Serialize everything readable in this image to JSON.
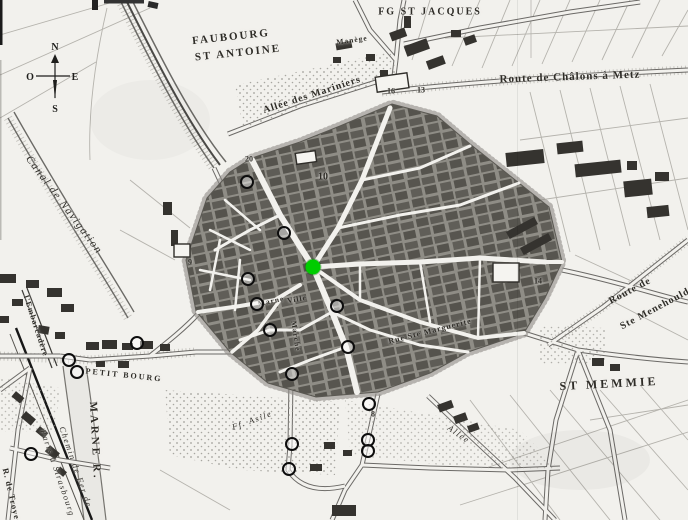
{
  "colors": {
    "paper": "#f2f1ed",
    "ink": "#2e2c27",
    "marker_ring": "#0d0d0d",
    "highlight_green": "#00cc00"
  },
  "compass": {
    "north": "N",
    "west": "O",
    "east": "E",
    "south": "S"
  },
  "labels": [
    {
      "id": "faubourg-line1",
      "text": "Faubourg",
      "x": 231,
      "y": 37,
      "rot": -6,
      "size": 11,
      "cls": "caps"
    },
    {
      "id": "faubourg-line2",
      "text": "St Antoine",
      "x": 238,
      "y": 53,
      "rot": -6,
      "size": 11,
      "cls": "caps"
    },
    {
      "id": "fg-st-jacques",
      "text": "Fg St Jacques",
      "x": 430,
      "y": 12,
      "rot": 0,
      "size": 10,
      "cls": "caps"
    },
    {
      "id": "route-chalons-metz",
      "text": "Route de Châlons à Metz",
      "x": 570,
      "y": 77,
      "rot": -2,
      "size": 11,
      "cls": "road"
    },
    {
      "id": "allee-mariniers",
      "text": "Allée des Mariniers",
      "x": 312,
      "y": 95,
      "rot": -18,
      "size": 10,
      "cls": "road"
    },
    {
      "id": "manege",
      "text": "Manège",
      "x": 352,
      "y": 40,
      "rot": -8,
      "size": 7.5,
      "cls": "road"
    },
    {
      "id": "canal-navigation",
      "text": "Canal de Navigation",
      "x": 64,
      "y": 205,
      "rot": 53,
      "size": 11,
      "cls": "italic"
    },
    {
      "id": "embarcadere",
      "text": "l'Embarcadère",
      "x": 36,
      "y": 326,
      "rot": 72,
      "size": 8,
      "cls": "road"
    },
    {
      "id": "petit-bourg",
      "text": "Petit Bourg",
      "x": 124,
      "y": 375,
      "rot": 6,
      "size": 8,
      "cls": "caps"
    },
    {
      "id": "marne-r",
      "text": "Marne R.",
      "x": 95,
      "y": 441,
      "rot": 87,
      "size": 11,
      "cls": "big"
    },
    {
      "id": "chemin-de-fer",
      "text": "Chemin de Fer de",
      "x": 76,
      "y": 467,
      "rot": 71,
      "size": 8.5,
      "cls": "italic"
    },
    {
      "id": "paris-strasbourg",
      "text": "Paris à Strasbourg",
      "x": 58,
      "y": 473,
      "rot": 71,
      "size": 8.5,
      "cls": "italic"
    },
    {
      "id": "r-de-troyes",
      "text": "R. de Troyes",
      "x": 12,
      "y": 496,
      "rot": 77,
      "size": 8.5,
      "cls": "road"
    },
    {
      "id": "st-memmie",
      "text": "St Memmie",
      "x": 609,
      "y": 384,
      "rot": -3,
      "size": 12,
      "cls": "big"
    },
    {
      "id": "route-de",
      "text": "Route de",
      "x": 630,
      "y": 291,
      "rot": -28,
      "size": 10,
      "cls": "road"
    },
    {
      "id": "ste-menehould",
      "text": "Ste Menehould",
      "x": 655,
      "y": 309,
      "rot": -28,
      "size": 10,
      "cls": "road"
    },
    {
      "id": "allee",
      "text": "Allée",
      "x": 459,
      "y": 434,
      "rot": 35,
      "size": 8.5,
      "cls": "italic"
    },
    {
      "id": "ff-asile",
      "text": "Ff. Asile",
      "x": 252,
      "y": 420,
      "rot": -20,
      "size": 8.5,
      "cls": "italic"
    },
    {
      "id": "marne-street",
      "text": "Marne",
      "x": 271,
      "y": 301,
      "rot": -12,
      "size": 7.5,
      "cls": "road"
    },
    {
      "id": "ville-street",
      "text": "Ville",
      "x": 297,
      "y": 299,
      "rot": -10,
      "size": 7.5,
      "cls": "road"
    },
    {
      "id": "marche-street",
      "text": "Marché",
      "x": 296,
      "y": 336,
      "rot": 82,
      "size": 7.5,
      "cls": "road"
    },
    {
      "id": "rue-ste-marguerite",
      "text": "Rue Ste Marguerite",
      "x": 430,
      "y": 331,
      "rot": -14,
      "size": 8,
      "cls": "road"
    },
    {
      "id": "num-20",
      "text": "20",
      "x": 249,
      "y": 159,
      "rot": 0,
      "size": 8,
      "cls": "num"
    },
    {
      "id": "num-10",
      "text": "10",
      "x": 323,
      "y": 177,
      "rot": 0,
      "size": 10,
      "cls": "num"
    },
    {
      "id": "num-16",
      "text": "16",
      "x": 391,
      "y": 91,
      "rot": 0,
      "size": 8,
      "cls": "num"
    },
    {
      "id": "num-13",
      "text": "13",
      "x": 421,
      "y": 90,
      "rot": 0,
      "size": 8,
      "cls": "num"
    },
    {
      "id": "num-14",
      "text": "14",
      "x": 538,
      "y": 281,
      "rot": 0,
      "size": 8,
      "cls": "num"
    },
    {
      "id": "num-8",
      "text": "8",
      "x": 373,
      "y": 414,
      "rot": 0,
      "size": 8,
      "cls": "num"
    },
    {
      "id": "num-9",
      "text": "9",
      "x": 190,
      "y": 262,
      "rot": 0,
      "size": 8,
      "cls": "num"
    }
  ],
  "markers": [
    {
      "x": 247,
      "y": 182
    },
    {
      "x": 284,
      "y": 233
    },
    {
      "x": 248,
      "y": 279
    },
    {
      "x": 257,
      "y": 304
    },
    {
      "x": 270,
      "y": 330
    },
    {
      "x": 337,
      "y": 306
    },
    {
      "x": 348,
      "y": 347
    },
    {
      "x": 292,
      "y": 374
    },
    {
      "x": 137,
      "y": 343
    },
    {
      "x": 69,
      "y": 360
    },
    {
      "x": 77,
      "y": 372
    },
    {
      "x": 31,
      "y": 454
    },
    {
      "x": 369,
      "y": 404
    },
    {
      "x": 368,
      "y": 440
    },
    {
      "x": 368,
      "y": 451
    },
    {
      "x": 292,
      "y": 444
    },
    {
      "x": 289,
      "y": 469
    }
  ],
  "highlight_marker": {
    "x": 313,
    "y": 267
  }
}
